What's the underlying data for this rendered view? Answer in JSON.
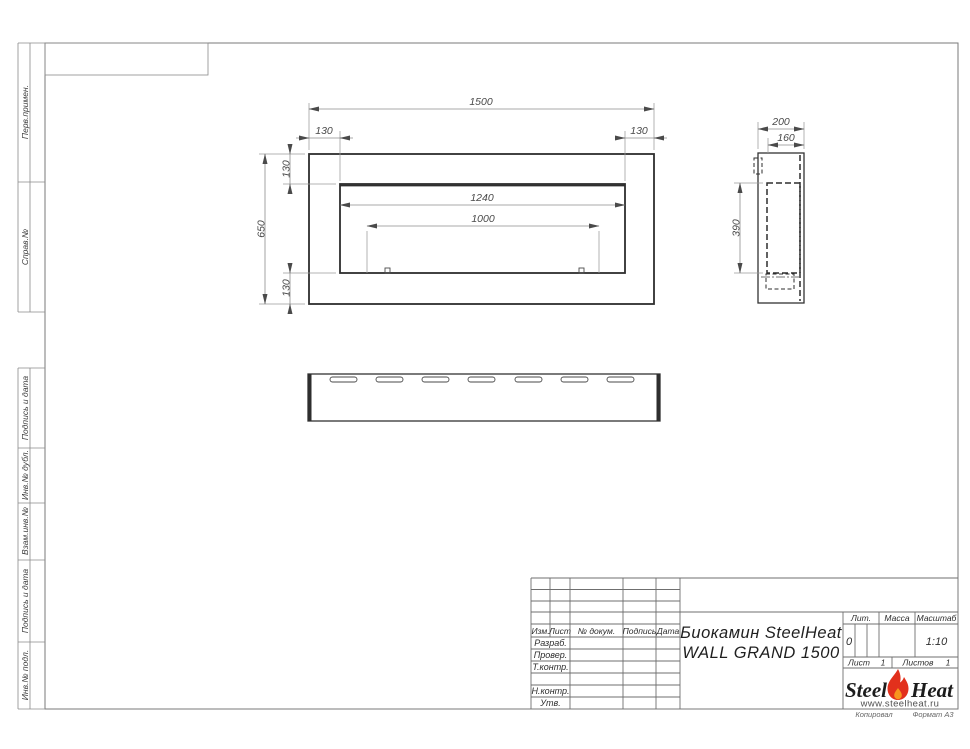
{
  "strips": {
    "labels": [
      "Перв.примен.",
      "Справ.№",
      "Подпись и дата",
      "Инв.№ дубл.",
      "Взам.инв.№",
      "Подпись и дата",
      "Инв.№ подл."
    ]
  },
  "views": {
    "front": {
      "dims": {
        "width": "1500",
        "height": "650",
        "inset_left": "130",
        "inset_right": "130",
        "inset_top": "130",
        "inset_bottom": "130",
        "opening_width": "1240",
        "burner_width": "1000"
      }
    },
    "side": {
      "dims": {
        "depth": "200",
        "inner_depth": "160",
        "opening_height": "390"
      }
    }
  },
  "title_block": {
    "header": {
      "izm": "Изм.",
      "list": "Лист",
      "doc": "№ докум.",
      "podpis": "Подпись",
      "data": "Дата"
    },
    "rows": {
      "razrab": "Разраб.",
      "prover": "Провер.",
      "tkontr": "Т.контр.",
      "nkontr": "Н.контр.",
      "utv": "Утв."
    },
    "name_line1": "Биокамин SteelHeat",
    "name_line2": "WALL GRAND 1500",
    "lit_label": "Лит.",
    "lit_value": "0",
    "mass_label": "Масса",
    "mass_value": "",
    "scale_label": "Масштаб",
    "scale_value": "1:10",
    "sheet_label": "Лист",
    "sheet_value": "1",
    "sheets_label": "Листов",
    "sheets_value": "1",
    "logo": {
      "steel": "Steel",
      "heat": "Heat",
      "site": "www.steelheat.ru"
    },
    "footer": {
      "copied": "Копировал",
      "format": "Формат А3"
    }
  },
  "colors": {
    "line": "#2e2e2e",
    "dim_arrow": "#4a4a4a",
    "flame_red": "#e2301c",
    "flame_orange": "#f7941d"
  }
}
